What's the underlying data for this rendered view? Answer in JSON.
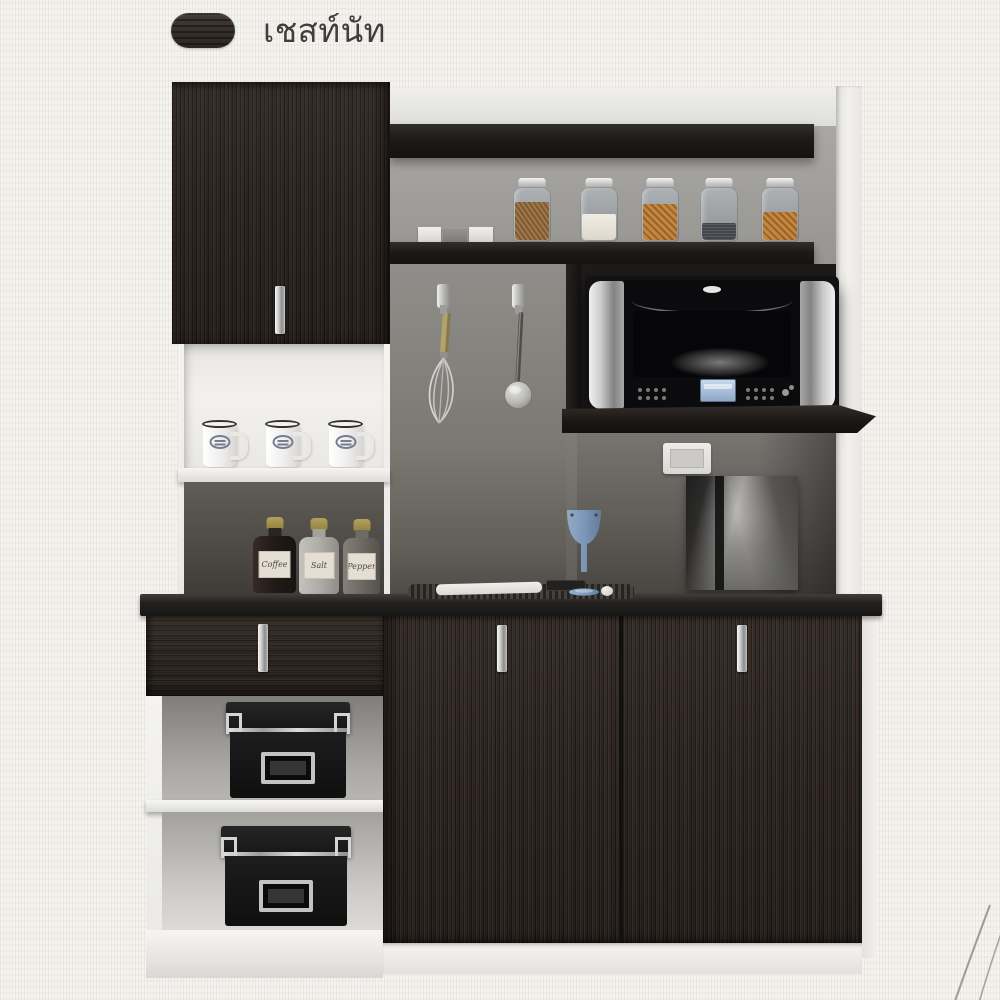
{
  "header": {
    "swatch_icon": "wood-finish-swatch-icon",
    "finish_name": "เชสท์นัท"
  },
  "colors": {
    "background": "#f5f4f0",
    "title_text": "#403d3a",
    "wood_dark": "#2b2521",
    "carcass_white": "#f1f0ed",
    "back_panel_gray": "#96948f",
    "chrome": "#c9c9c9",
    "counter_black": "#201d1b",
    "wine_glass_blue": "#7f9cc0",
    "whisk_handle_tan": "#b2a26c",
    "microwave_display_blue": "#a8c0dc",
    "decor_arc": "#8e8378"
  },
  "scene": {
    "spice_jars": [
      {
        "label": "Coffee"
      },
      {
        "label": "Salt"
      },
      {
        "label": "Pepper"
      }
    ],
    "objects": [
      "upper-cabinet-door",
      "open-hutch-shelves",
      "glass-pantry-jars",
      "napkin-boxes",
      "coffee-mugs",
      "hanging-whisk",
      "hanging-ladle",
      "microwave-oven",
      "wall-outlet",
      "framed-city-photo",
      "placemat-with-napkin",
      "wine-glass",
      "drawer",
      "storage-boxes",
      "double-door-base-cabinet"
    ]
  }
}
